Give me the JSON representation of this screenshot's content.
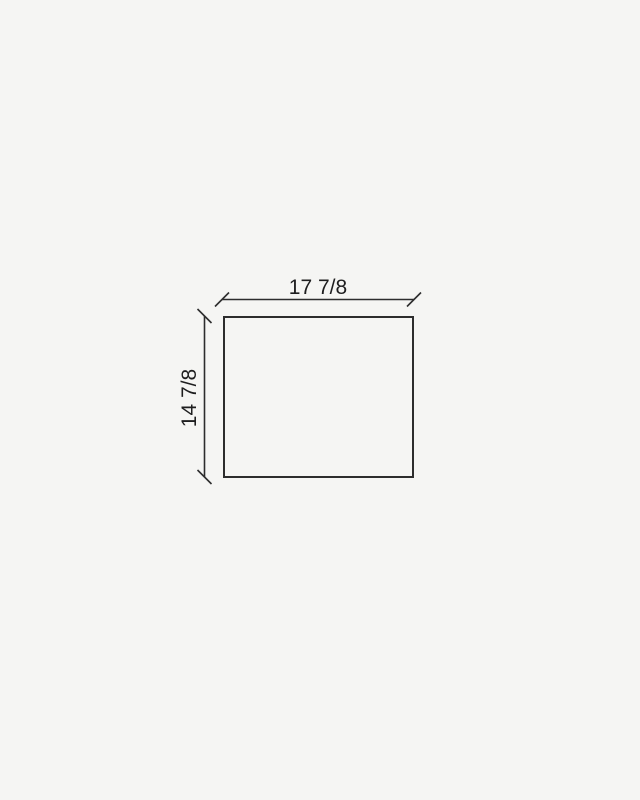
{
  "drawing": {
    "kind": "dimensioned-rectangle",
    "width_dimension": {
      "label": "17 7/8"
    },
    "height_dimension": {
      "label": "14 7/8"
    }
  },
  "colors": {
    "background": "#f5f5f3",
    "line": "#2d2d2d",
    "text": "#1e1e1f"
  }
}
